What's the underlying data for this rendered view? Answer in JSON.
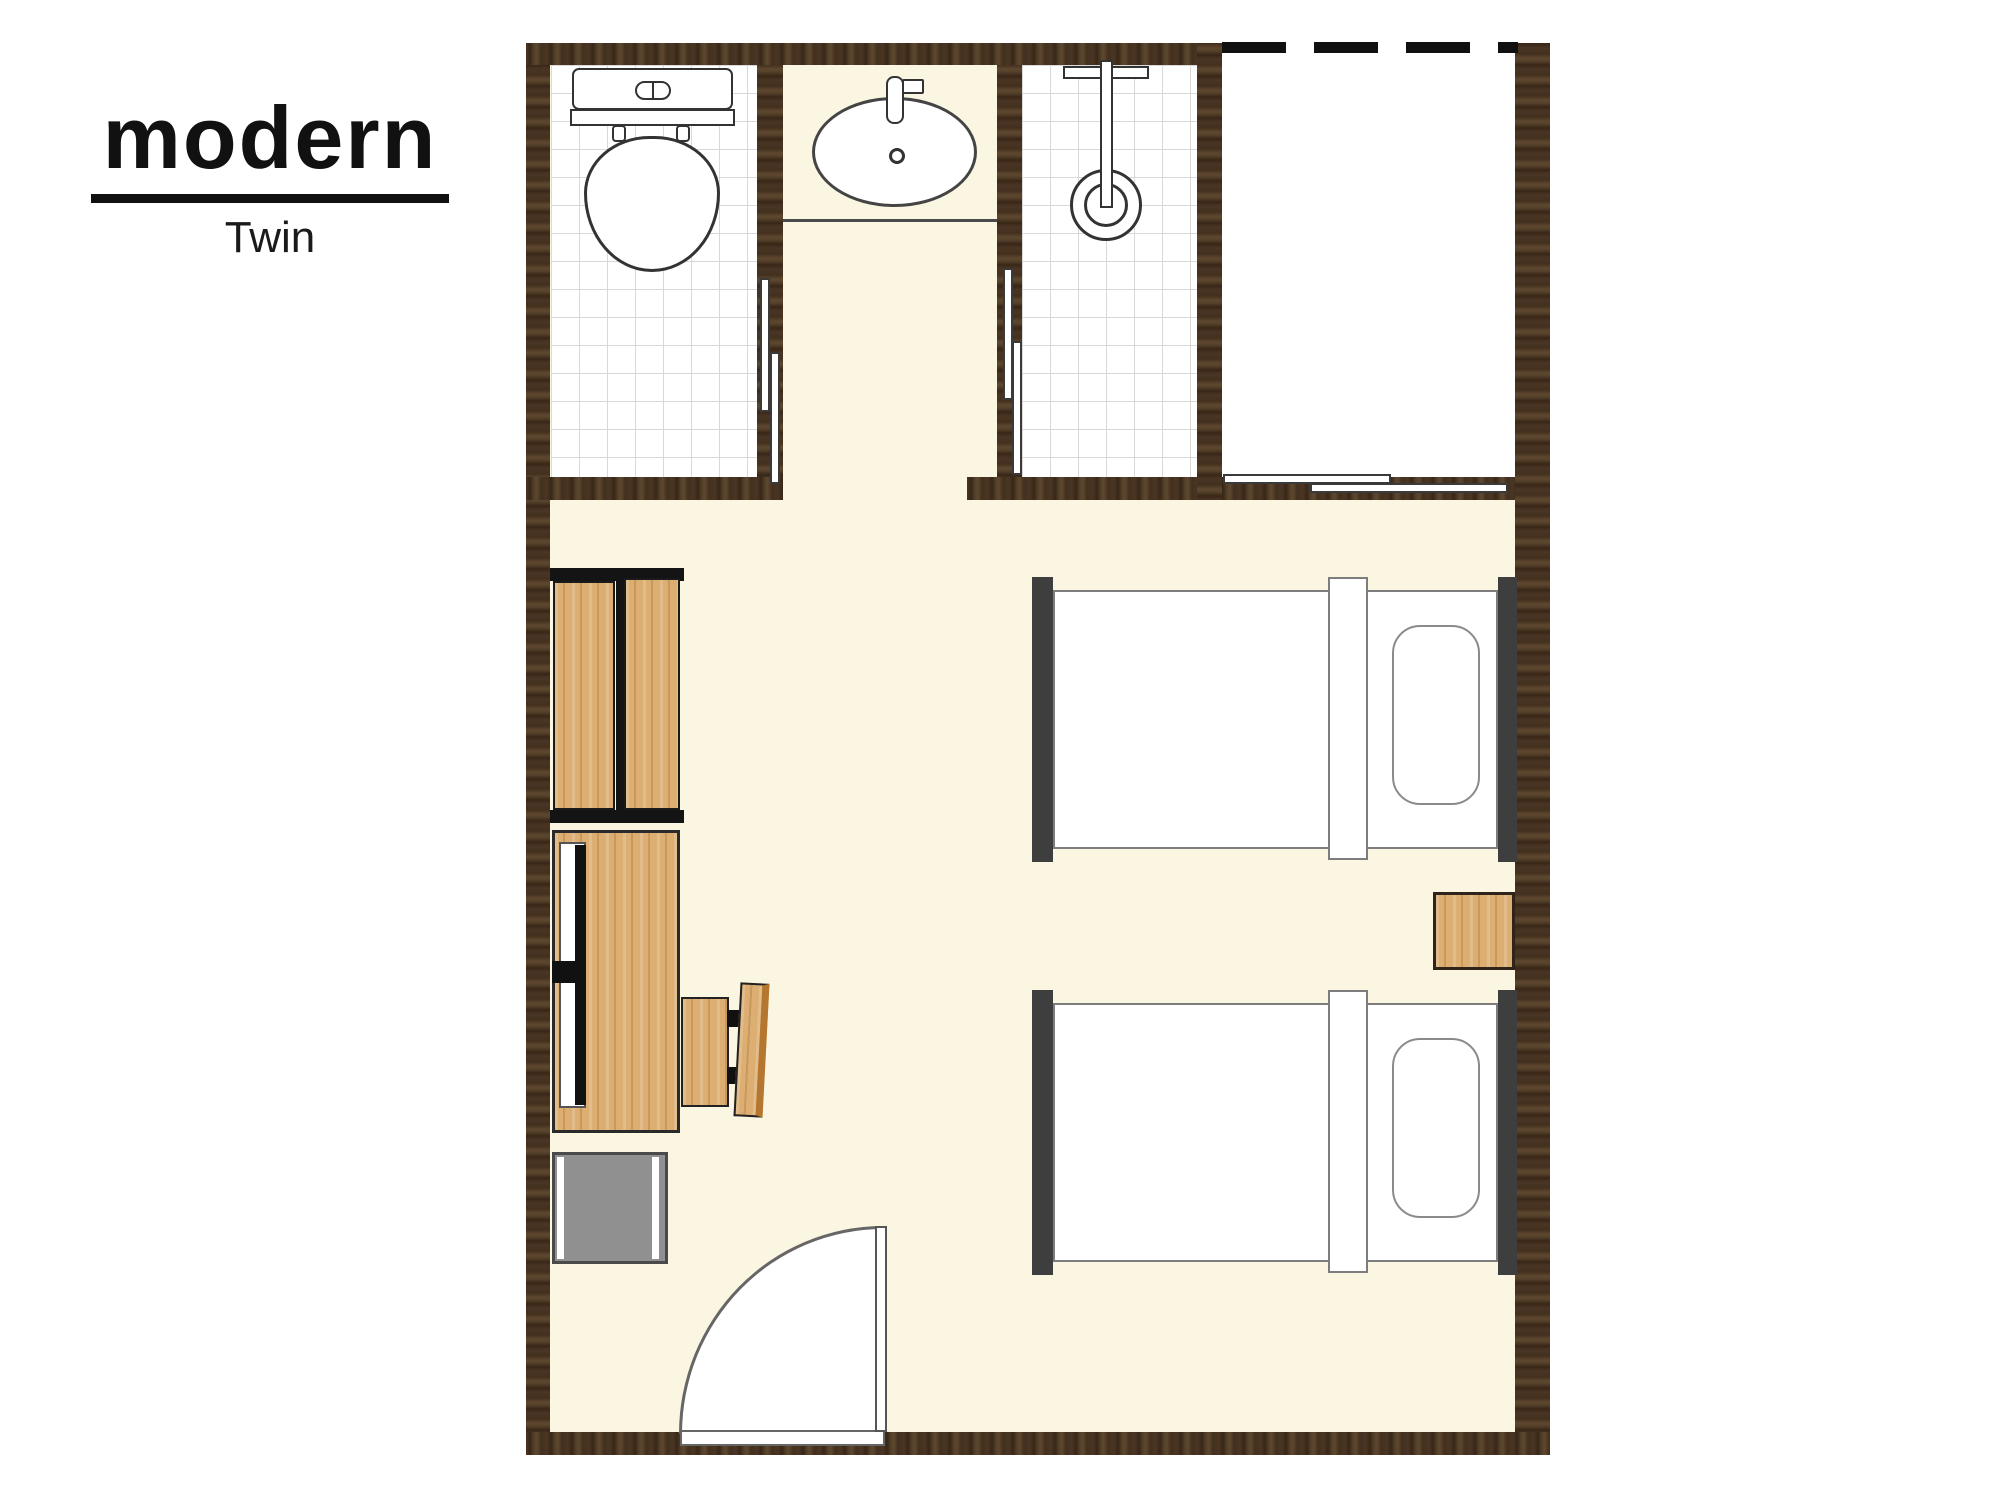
{
  "title": "modern",
  "subtitle": "Twin",
  "plan": {
    "type": "hotel-room-floor-plan",
    "rooms": [
      {
        "name": "toilet-room"
      },
      {
        "name": "washbasin-alcove"
      },
      {
        "name": "shower-room"
      },
      {
        "name": "closet"
      },
      {
        "name": "bedroom"
      }
    ],
    "furniture": [
      {
        "name": "toilet"
      },
      {
        "name": "washbasin"
      },
      {
        "name": "shower-head"
      },
      {
        "name": "sliding-door-toilet"
      },
      {
        "name": "sliding-door-shower"
      },
      {
        "name": "sliding-door-closet"
      },
      {
        "name": "wardrobe"
      },
      {
        "name": "desk"
      },
      {
        "name": "tv"
      },
      {
        "name": "chair"
      },
      {
        "name": "mini-fridge"
      },
      {
        "name": "nightstand"
      },
      {
        "name": "single-bed-1"
      },
      {
        "name": "single-bed-2"
      },
      {
        "name": "entrance-door"
      }
    ],
    "colors": {
      "wall_wood": "#4a3524",
      "floor_cream": "#faf6e2",
      "bathroom_tile": "#ffffff",
      "tile_grid_line": "#d9d9d9",
      "furniture_wood": "#dcae72",
      "bed_frame_dark": "#3e3e3e",
      "fridge_gray": "#909090",
      "fixture_outline": "#4a4a4a",
      "accent_black": "#111111"
    }
  }
}
